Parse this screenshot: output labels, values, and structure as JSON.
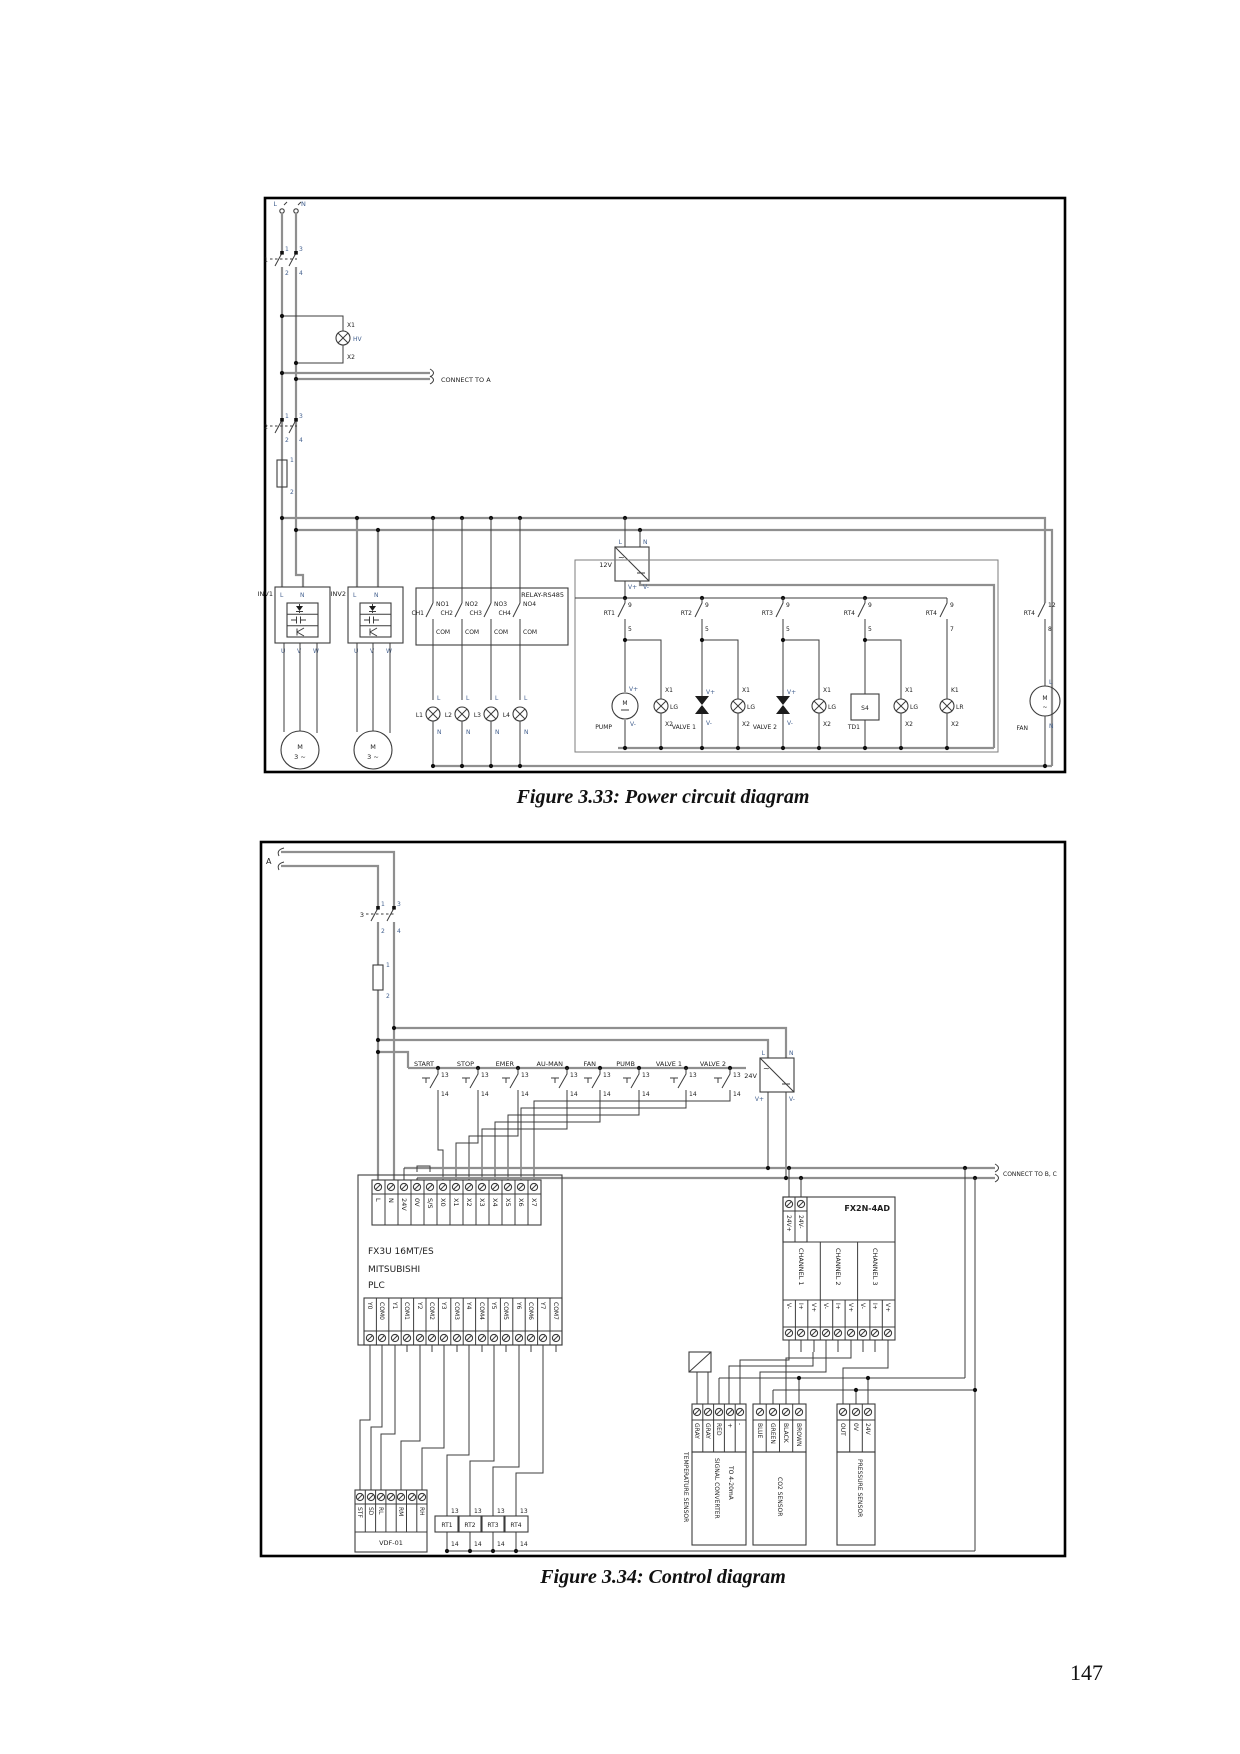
{
  "figure1": {
    "caption": "Figure 3.33: Power circuit diagram",
    "mains": {
      "l": "L",
      "n": "N"
    },
    "breaker1": {
      "name": "1"
    },
    "breaker2": {
      "name": "2"
    },
    "bpins": {
      "t1": "1",
      "t2": "2",
      "t3": "3",
      "t4": "4"
    },
    "fuse": {
      "t1": "1",
      "t2": "2"
    },
    "pilot": {
      "x1": "X1",
      "x2": "X2",
      "name": "HV"
    },
    "connect_a": "CONNECT TO A",
    "inv1": "INV1",
    "inv2": "INV2",
    "pins": {
      "l": "L",
      "n": "N",
      "u": "U",
      "v": "V",
      "w": "W",
      "vp": "V+",
      "vm": "V-"
    },
    "motor": {
      "m": "M",
      "ph": "3 ~"
    },
    "psu": {
      "label": "12V"
    },
    "relay": {
      "title": "RELAY-RS485",
      "com": "COM",
      "ch": [
        "CH1",
        "CH2",
        "CH3",
        "CH4"
      ],
      "no": [
        "NO1",
        "NO2",
        "NO3",
        "NO4"
      ]
    },
    "lamps": [
      "L1",
      "L2",
      "L3",
      "L4"
    ],
    "rts": [
      "RT1",
      "RT2",
      "RT3",
      "RT4"
    ],
    "rt": {
      "t": "9",
      "b": "5",
      "b5": "7",
      "x1": "X1",
      "x2": "X2",
      "k1": "K1",
      "lg": "LG",
      "lr": "LR"
    },
    "loads": {
      "pump": "PUMP",
      "valve1": "VALVE 1",
      "valve2": "VALVE 2",
      "td": "TD1",
      "s4": "S4"
    },
    "fan": {
      "t": "12",
      "b": "8",
      "name": "FAN",
      "ph": "~"
    }
  },
  "figure2": {
    "caption": "Figure 3.34: Control diagram",
    "connector_a": "A",
    "breaker": {
      "name": "3"
    },
    "bpins": {
      "t1": "1",
      "t2": "2",
      "t3": "3",
      "t4": "4"
    },
    "fuse": {
      "t1": "1",
      "t2": "2"
    },
    "buttons": [
      "START",
      "STOP",
      "EMER",
      "AU-MAN",
      "FAN",
      "PUMB",
      "VALVE 1",
      "VALVE 2"
    ],
    "btn": {
      "t": "13",
      "b": "14"
    },
    "psu": {
      "label": "24V",
      "l": "L",
      "n": "N",
      "vp": "V+",
      "vm": "V-"
    },
    "connect_bc": "CONNECT TO B, C",
    "plc": {
      "line1": "FX3U 16MT/ES",
      "line2": "MITSUBISHI",
      "line3": "PLC",
      "top": [
        "L",
        "N",
        "24V",
        "0V",
        "S/S",
        "X0",
        "X1",
        "X2",
        "X3",
        "X4",
        "X5",
        "X6",
        "X7"
      ],
      "bottom": [
        "Y0",
        "COM0",
        "Y1",
        "COM1",
        "Y2",
        "COM2",
        "Y3",
        "COM3",
        "Y4",
        "COM4",
        "Y5",
        "COM5",
        "Y6",
        "COM6",
        "Y7",
        "COM7"
      ]
    },
    "fx2n": {
      "title": "FX2N-4AD",
      "p": "24V+",
      "m": "24V-",
      "ch": [
        "CHANNEL 1",
        "CHANNEL 2",
        "CHANNEL 3"
      ],
      "pins": [
        "V-",
        "I+",
        "V+"
      ]
    },
    "vdf": {
      "title": "VDF-01",
      "pins": [
        "STF",
        "SD",
        "RL",
        "RM",
        "RH"
      ]
    },
    "rts": [
      "RT1",
      "RT2",
      "RT3",
      "RT4"
    ],
    "rt": {
      "t": "13",
      "b": "14"
    },
    "temp": {
      "label": "TEMPERATURE SENSOR",
      "pins": [
        "GRAY",
        "GRAY",
        "RED",
        "+",
        "-"
      ],
      "conv1": "SIGNAL CONVERTER",
      "conv2": "TO 4-20mA"
    },
    "co2": {
      "label": "CO2 SENSOR",
      "pins": [
        "BLUE",
        "GREEN",
        "BLACK",
        "BROWN"
      ]
    },
    "pressure": {
      "label": "PRESSURE SENSOR",
      "pins": [
        "OUT",
        "0V",
        "24V"
      ]
    }
  },
  "page": {
    "number": "147"
  }
}
